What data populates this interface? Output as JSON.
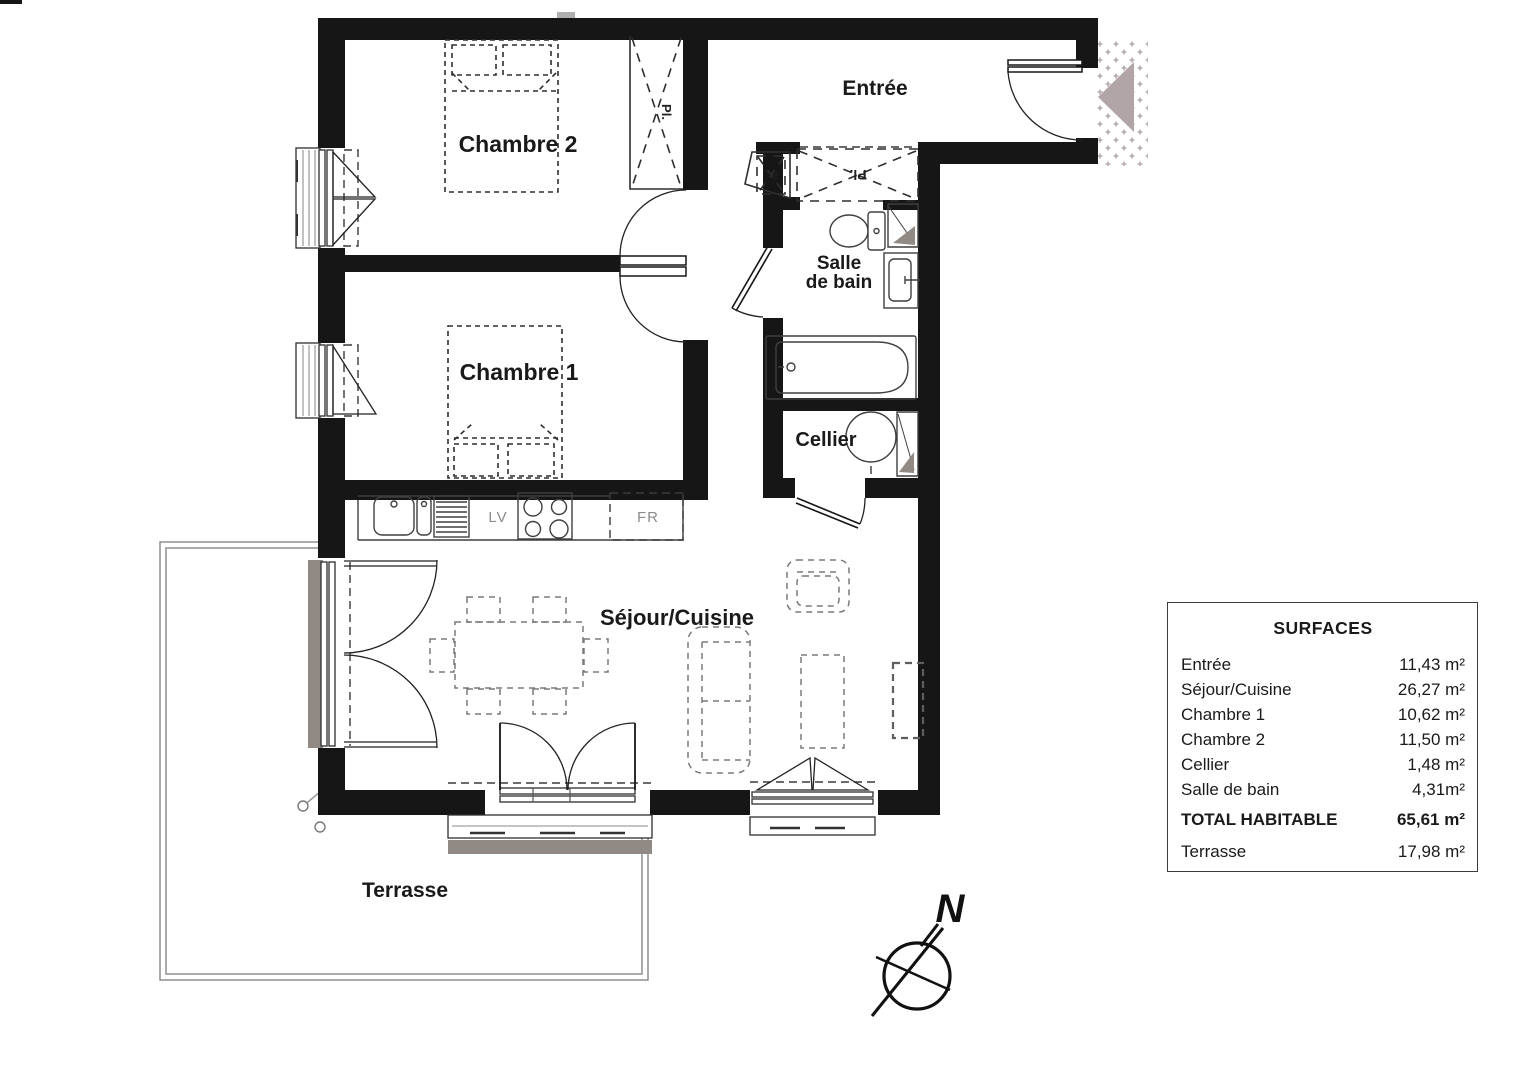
{
  "plan": {
    "rooms": {
      "entree": "Entrée",
      "sejour_cuisine": "Séjour/Cuisine",
      "chambre1": "Chambre 1",
      "chambre2": "Chambre 2",
      "cellier": "Cellier",
      "salle_de_bain_line1": "Salle",
      "salle_de_bain_line2": "de bain",
      "terrasse": "Terrasse"
    },
    "annotations": {
      "closet": "Pl.",
      "dishwasher": "LV",
      "fridge": "FR",
      "north": "N"
    }
  },
  "surfaces": {
    "title": "SURFACES",
    "rows": [
      {
        "label": "Entrée",
        "value": "11,43 m²"
      },
      {
        "label": "Séjour/Cuisine",
        "value": "26,27 m²"
      },
      {
        "label": "Chambre 1",
        "value": "10,62 m²"
      },
      {
        "label": "Chambre 2",
        "value": "11,50 m²"
      },
      {
        "label": "Cellier",
        "value": "1,48 m²"
      },
      {
        "label": "Salle de bain",
        "value": "4,31m²"
      },
      {
        "label": "TOTAL HABITABLE",
        "value": "65,61 m²"
      },
      {
        "label": "Terrasse",
        "value": "17,98 m²"
      }
    ]
  },
  "colors": {
    "bg": "#ffffff",
    "wall": "#161616",
    "line": "#2e2e2e",
    "furniture": "#7a7a7a",
    "fixture": "#3f3f3f",
    "sill": "#918a84",
    "marker": "#b1a5a7",
    "terrace": "#8f8f8f",
    "label": "#1a1a1a",
    "label_muted": "#8c8c8c"
  }
}
